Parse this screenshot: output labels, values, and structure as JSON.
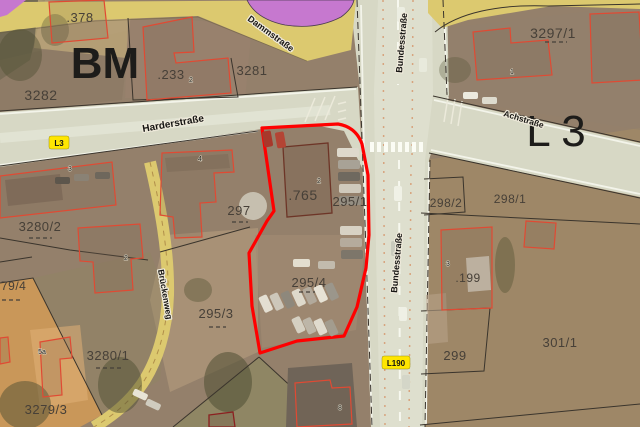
{
  "map_type": "cadastral-aerial-map",
  "parcel_labels": {
    "p378": ".378",
    "bm": "BM",
    "p3282": "3282",
    "p233": ".233",
    "p3281": "3281",
    "p3297_1": "3297/1",
    "l3_big": "L 3",
    "p298_2": "298/2",
    "p298_1": "298/1",
    "p199": ".199",
    "p299": "299",
    "p301_1": "301/1",
    "p295_1": "295/1",
    "p765": ".765",
    "p297": "297",
    "p295_4": "295/4",
    "p295_3": "295/3",
    "p3280_2": "3280/2",
    "p3280_1": "3280/1",
    "p3279_3": "3279/3",
    "p79_4": "79/4"
  },
  "building_labels": {
    "b1": "1",
    "b2_233": "2",
    "b2_765": "2",
    "b2": "2",
    "b3_left": "3",
    "b3_199": "3",
    "b4": "4",
    "b5a": "5a",
    "b8": "8"
  },
  "street_labels": {
    "dammstrasse": "Dammstraße",
    "bundesstrasse_top": "Bundesstraße",
    "bundesstrasse_mid": "Bundesstraße",
    "harderstrasse": "Harderstraße",
    "achstrasse": "Achstraße",
    "brueckenweg": "Brückenweg"
  },
  "road_badges": {
    "l3": "L3",
    "l190": "L190"
  },
  "colors": {
    "selection": "#ff0000",
    "road_badge_bg": "#ffe600",
    "purple_zone": "#c678cf",
    "yellow_road": "#dcc96f",
    "building_outline": "#e04a33",
    "road_gray": "#d7d8c5"
  }
}
